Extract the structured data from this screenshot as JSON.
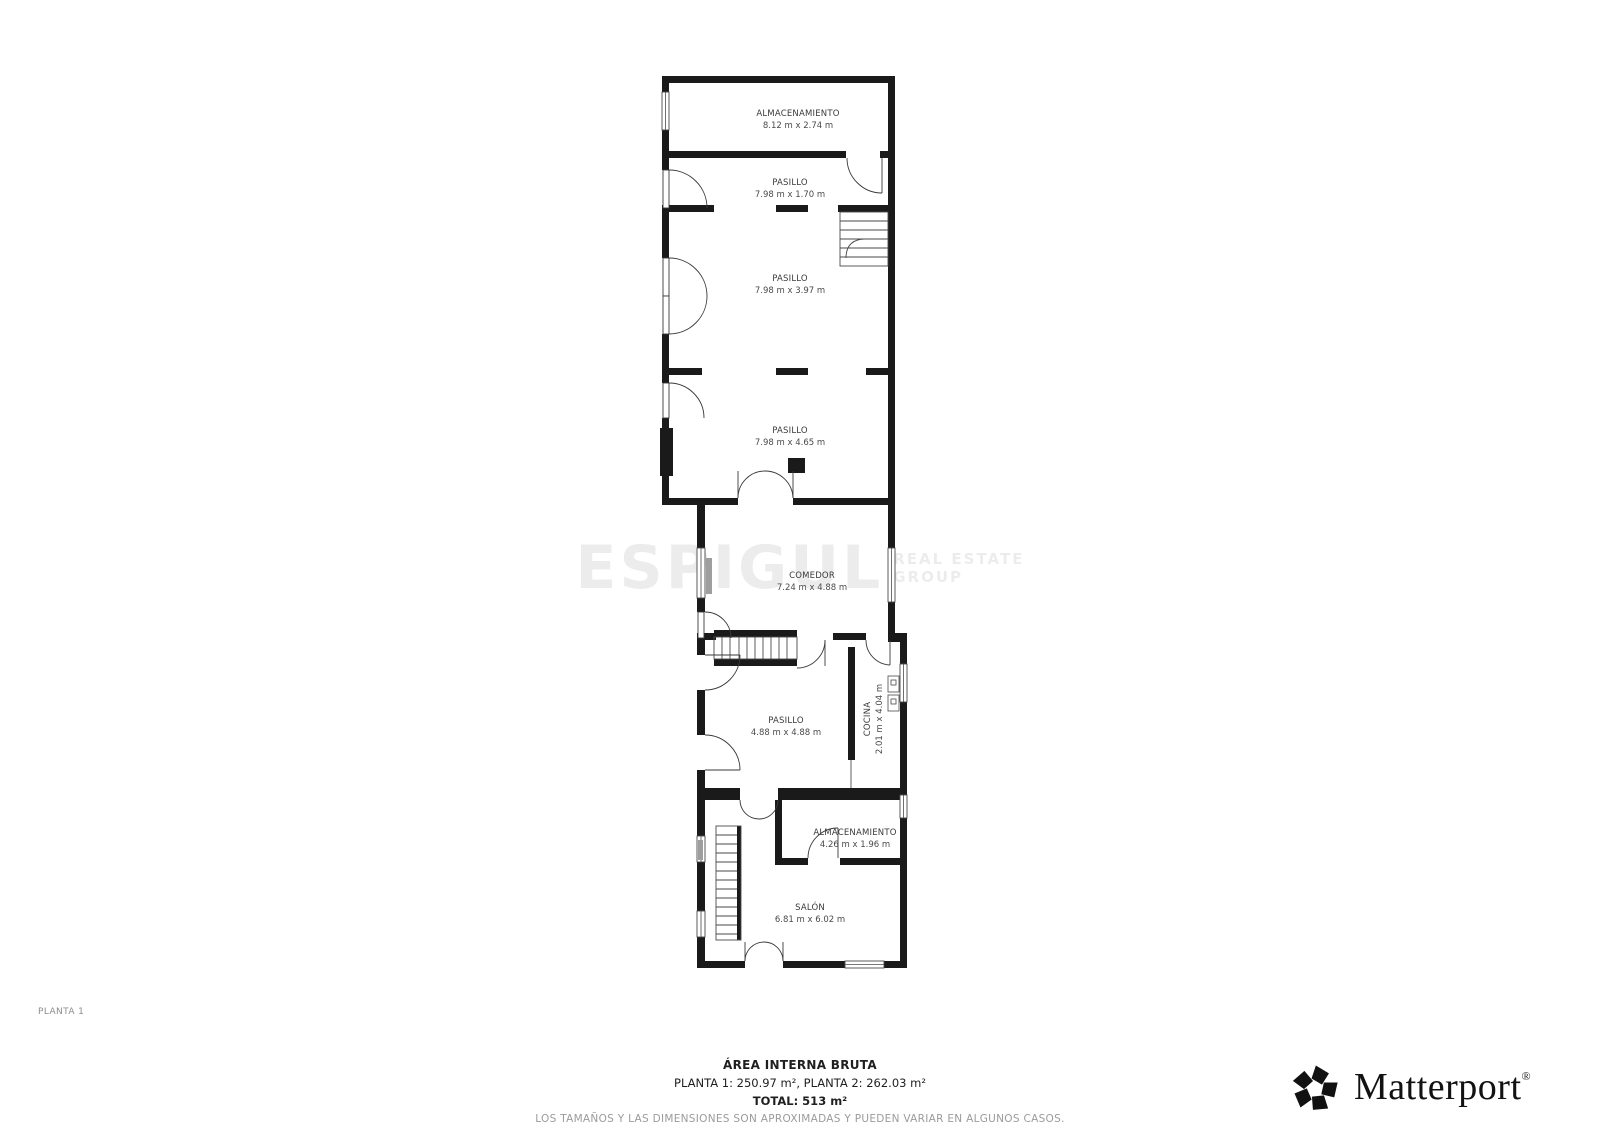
{
  "floor_label": "PLANTA 1",
  "watermark": {
    "brand": "ESPIGUL",
    "tagline_line1": "REAL ESTATE",
    "tagline_line2": "GROUP"
  },
  "rooms": [
    {
      "name": "ALMACENAMIENTO",
      "dims": "8.12 m x 2.74 m"
    },
    {
      "name": "PASILLO",
      "dims": "7.98 m x 1.70 m"
    },
    {
      "name": "PASILLO",
      "dims": "7.98 m x 3.97 m"
    },
    {
      "name": "PASILLO",
      "dims": "7.98 m x 4.65 m"
    },
    {
      "name": "COMEDOR",
      "dims": "7.24 m x 4.88 m"
    },
    {
      "name": "PASILLO",
      "dims": "4.88 m x 4.88 m"
    },
    {
      "name": "COCINA",
      "dims": "2.01 m x 4.04 m"
    },
    {
      "name": "ALMACENAMIENTO",
      "dims": "4.26 m x 1.96 m"
    },
    {
      "name": "SALÓN",
      "dims": "6.81 m x 6.02 m"
    }
  ],
  "footer": {
    "area_title": "ÁREA INTERNA BRUTA",
    "area_line": "PLANTA 1: 250.97 m², PLANTA 2: 262.03 m²",
    "total_line": "TOTAL: 513 m²",
    "disclaimer": "LOS TAMAÑOS Y LAS DIMENSIONES SON APROXIMADAS Y PUEDEN VARIAR EN ALGUNOS CASOS."
  },
  "branding": {
    "logo_text": "Matterport",
    "registered_mark": "®"
  },
  "colors": {
    "wall": "#1a1a1a",
    "thin_line": "#4a4a4a",
    "radiator": "#9e9e9e",
    "disclaimer": "#9b9b9b"
  }
}
